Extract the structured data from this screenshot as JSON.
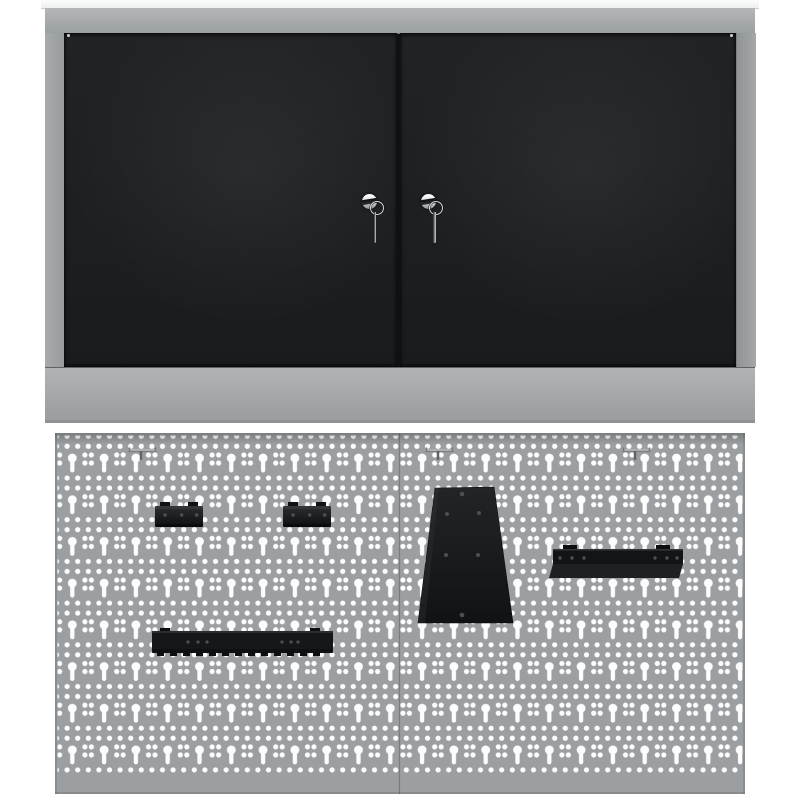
{
  "scene": {
    "type": "product-photo",
    "subject": "Wall-mounted workshop cabinet with two black lockable doors (keys in locks) above a two-panel perforated steel pegboard fitted with black tool holders",
    "background": "#ffffff"
  },
  "colors": {
    "peg": "#9b9fa1",
    "hole": "#fdfdfe",
    "frame": "#9fa3a5",
    "door": "#1d1f21",
    "holder": "#141619",
    "chrome": "#e8eaeb"
  },
  "cabinet": {
    "label": "wall cabinet",
    "top_panel": "white top panel",
    "doors": [
      {
        "label": "left door",
        "lock": "cylinder lock",
        "key": "key on ring"
      },
      {
        "label": "right door",
        "lock": "cylinder lock",
        "key": "key on ring"
      }
    ],
    "keys_count": 2
  },
  "pegboard": {
    "label": "perforated tool wall",
    "panels": 2,
    "items": [
      {
        "label": "wire hook",
        "count": 3
      },
      {
        "label": "small tool bracket",
        "count": 2
      },
      {
        "label": "saw holder plate",
        "count": 1
      },
      {
        "label": "tool rail",
        "count": 1
      },
      {
        "label": "long tool holder rail",
        "count": 1
      }
    ]
  }
}
